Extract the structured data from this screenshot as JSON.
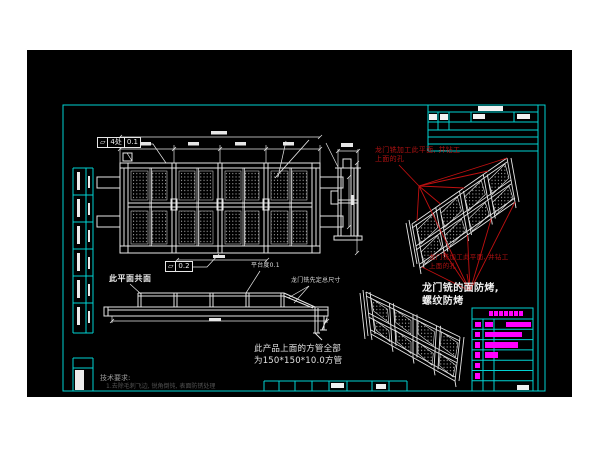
{
  "colors": {
    "background": "#ffffff",
    "canvas": "#000000",
    "frame-cyan": "#00d2d2",
    "line-white": "#e6e6e6",
    "annotation-red": "#c01010",
    "red-text": "#b01212",
    "magenta": "#ff00ff",
    "gray-text": "#9a9a9a",
    "dim-text": "#525252"
  },
  "drawing": {
    "gdt_flatness_1": {
      "symbol": "▱",
      "zone": "4处",
      "tolerance": "0.1"
    },
    "gdt_flatness_2": {
      "symbol": "▱",
      "tolerance": "0.2"
    },
    "labels": {
      "coplanar": "此平面共面",
      "platform_flatness": "平台度0.1",
      "gantry_mill_overall": "龙门铣先定总尺寸",
      "square_tube_line1": "此产品上面的方管全部",
      "square_tube_line2": "为150*150*10.0方管",
      "white_note_line1": "龙门铣的面防烤,",
      "white_note_line2": "螺纹防烤",
      "red_note_top_line1": "龙门铣加工此平面, 并钻工",
      "red_note_top_line2": "上面的孔",
      "red_note_mid_line1": "龙门铣加工此平面, 并钻工",
      "red_note_mid_line2": "上面的孔",
      "tech_req_title": "技术要求:",
      "tech_req_item": "1.去除毛刺飞边, 锐角倒钝, 表面防锈处理"
    }
  },
  "parts_table": {
    "header_blocks": [
      {
        "x": 17,
        "w": 3.8
      },
      {
        "x": 22,
        "w": 3.8
      },
      {
        "x": 27,
        "w": 3.8
      },
      {
        "x": 32,
        "w": 3.8
      },
      {
        "x": 37,
        "w": 3.8
      },
      {
        "x": 42,
        "w": 3.8
      },
      {
        "x": 47,
        "w": 3.8
      }
    ],
    "header_h": 11,
    "row_h": 10.3,
    "bar_h": 5.5,
    "row_bars": [
      [
        {
          "x": 3,
          "w": 6
        },
        {
          "x": 13,
          "w": 8
        },
        {
          "x": 34,
          "w": 25
        }
      ],
      [
        {
          "x": 3,
          "w": 5
        },
        {
          "x": 13,
          "w": 37
        }
      ],
      [
        {
          "x": 3,
          "w": 5
        },
        {
          "x": 13,
          "w": 33
        }
      ],
      [
        {
          "x": 3,
          "w": 5
        },
        {
          "x": 13,
          "w": 13
        }
      ],
      [
        {
          "x": 3,
          "w": 5
        }
      ],
      [
        {
          "x": 3,
          "w": 5
        }
      ],
      []
    ]
  }
}
